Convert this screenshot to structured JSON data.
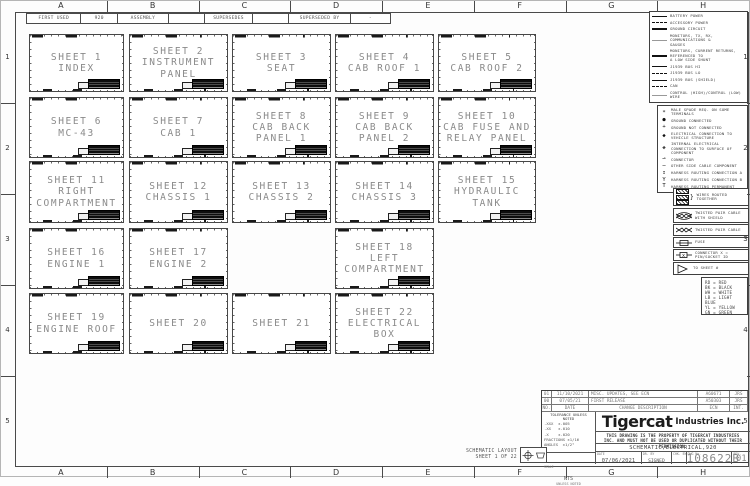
{
  "header_bar": {
    "cells": [
      "FIRST USED",
      "920",
      "ASSEMBLY",
      "",
      "SUPERSEDES",
      "",
      "SUPERSEDED BY",
      "-"
    ]
  },
  "border": {
    "columns": [
      "A",
      "B",
      "C",
      "D",
      "E",
      "F",
      "G",
      "H"
    ],
    "rows": [
      "1",
      "2",
      "3",
      "4",
      "5"
    ]
  },
  "sheets": [
    {
      "title": "SHEET 1",
      "lines": [
        "INDEX"
      ],
      "row": 0,
      "col": 0
    },
    {
      "title": "SHEET 2",
      "lines": [
        "INSTRUMENT",
        "PANEL"
      ],
      "row": 0,
      "col": 1
    },
    {
      "title": "SHEET 3",
      "lines": [
        "SEAT"
      ],
      "row": 0,
      "col": 2
    },
    {
      "title": "SHEET 4",
      "lines": [
        "CAB ROOF 1"
      ],
      "row": 0,
      "col": 3
    },
    {
      "title": "SHEET 5",
      "lines": [
        "CAB ROOF 2"
      ],
      "row": 0,
      "col": 4
    },
    {
      "title": "SHEET 6",
      "lines": [
        "MC-43"
      ],
      "row": 1,
      "col": 0
    },
    {
      "title": "SHEET 7",
      "lines": [
        "CAB 1"
      ],
      "row": 1,
      "col": 1
    },
    {
      "title": "SHEET 8",
      "lines": [
        "CAB BACK",
        "PANEL 1"
      ],
      "row": 1,
      "col": 2
    },
    {
      "title": "SHEET 9",
      "lines": [
        "CAB BACK",
        "PANEL 2"
      ],
      "row": 1,
      "col": 3
    },
    {
      "title": "SHEET 10",
      "lines": [
        "CAB FUSE AND",
        "RELAY PANEL"
      ],
      "row": 1,
      "col": 4
    },
    {
      "title": "SHEET 11",
      "lines": [
        "RIGHT",
        "COMPARTMENT"
      ],
      "row": 2,
      "col": 0
    },
    {
      "title": "SHEET 12",
      "lines": [
        "CHASSIS 1"
      ],
      "row": 2,
      "col": 1
    },
    {
      "title": "SHEET 13",
      "lines": [
        "CHASSIS 2"
      ],
      "row": 2,
      "col": 2
    },
    {
      "title": "SHEET 14",
      "lines": [
        "CHASSIS 3"
      ],
      "row": 2,
      "col": 3
    },
    {
      "title": "SHEET 15",
      "lines": [
        "HYDRAULIC",
        "TANK"
      ],
      "row": 2,
      "col": 4
    },
    {
      "title": "SHEET 16",
      "lines": [
        "ENGINE 1"
      ],
      "row": 3,
      "col": 0
    },
    {
      "title": "SHEET 17",
      "lines": [
        "ENGINE 2"
      ],
      "row": 3,
      "col": 1
    },
    {
      "title": "SHEET 18",
      "lines": [
        "LEFT",
        "COMPARTMENT"
      ],
      "row": 3,
      "col": 3
    },
    {
      "title": "SHEET 19",
      "lines": [
        "ENGINE ROOF"
      ],
      "row": 4,
      "col": 0
    },
    {
      "title": "SHEET 20",
      "lines": [],
      "row": 4,
      "col": 1
    },
    {
      "title": "SHEET 21",
      "lines": [],
      "row": 4,
      "col": 2
    },
    {
      "title": "SHEET 22",
      "lines": [
        "ELECTRICAL",
        "BOX"
      ],
      "row": 4,
      "col": 3
    }
  ],
  "legend": {
    "line_types": [
      {
        "style": "solid",
        "label": "BATTERY POWER"
      },
      {
        "style": "dash",
        "label": "ACCESSORY POWER"
      },
      {
        "style": "thick",
        "label": "GROUND CIRCUIT"
      },
      {
        "style": "thin",
        "label": "MONITORS, TX, RX, COMMUNICATIONS &",
        "label2": "GAUGES"
      },
      {
        "style": "thick",
        "label": "MONITORS, CURRENT RETURNS, REFERENCED TO",
        "label2": "A LOW SIDE SHUNT"
      },
      {
        "style": "solid",
        "label": "J1939 BUS HI"
      },
      {
        "style": "dash",
        "label": "J1939 BUS LO"
      },
      {
        "style": "solid",
        "label": "J1939 BUS (SHIELD)"
      },
      {
        "style": "dash",
        "label": "CAN"
      },
      {
        "style": "thin",
        "label": "CONTROL (HIGH)/CONTROL (LOW) WIRE"
      }
    ],
    "symbols": [
      {
        "icon": "∗",
        "icon_name": "spade-terminal-icon",
        "label": "MALE SPADE REQ. ON SOME TERMINALS"
      },
      {
        "icon": "●",
        "icon_name": "ground-connected-icon",
        "label": "GROUND CONNECTED"
      },
      {
        "icon": "+",
        "icon_name": "ground-not-connected-icon",
        "label": "GROUND NOT CONNECTED"
      },
      {
        "icon": "◆",
        "icon_name": "structure-connection-icon",
        "label": "ELECTRICAL CONNECTION TO VEHICLE STRUCTURE"
      },
      {
        "icon": "◈",
        "icon_name": "component-connection-icon",
        "label": "INTERNAL ELECTRICAL CONNECTION TO SURFACE OF COMPONENT"
      },
      {
        "icon": "⊸",
        "icon_name": "connector-icon",
        "label": "CONNECTOR"
      },
      {
        "icon": "⋯",
        "icon_name": "other-side-cable-icon",
        "label": "OTHER SIDE CABLE COMPONENT"
      },
      {
        "icon": "↧",
        "icon_name": "harness-routing-a-icon",
        "label": "HARNESS ROUTING CONNECTION A"
      },
      {
        "icon": "Y",
        "icon_name": "harness-routing-b-icon",
        "label": "HARNESS ROUTING CONNECTION B"
      },
      {
        "icon": "T",
        "icon_name": "harness-routing-perm-icon",
        "label": "HARNESS ROUTING PERMANENT"
      }
    ],
    "boxed": [
      {
        "icon": "routed",
        "label": "WIRES ROUTED TOGETHER"
      },
      {
        "icon": "twisted-shield",
        "label": "TWISTED PAIR CABLE WITH SHIELD"
      },
      {
        "icon": "twisted",
        "label": "TWISTED PAIR CABLE"
      },
      {
        "icon": "fuse",
        "label": "FUSE"
      },
      {
        "icon": "connector",
        "label": "CONNECTOR  X = PIN/SOCKET ID"
      },
      {
        "icon": "tosheet",
        "label": "TO SHEET #"
      }
    ],
    "wire_colors": [
      "RD = RED",
      "BK = BLACK",
      "WH = WHITE",
      "LB = LIGHT BLUE",
      "YL = YELLOW",
      "GN = GREEN"
    ]
  },
  "title_block": {
    "revision_headers": [
      "NO.",
      "DATE",
      "CHANGE DESCRIPTION",
      "ECN",
      "INT."
    ],
    "revisions": [
      [
        "01",
        "11/10/2021",
        "MISC. UPDATES, SEE ECN",
        "A60671",
        "JRS"
      ],
      [
        "00",
        "07/05/21",
        "FIRST RELEASE",
        "A50303",
        "JRS"
      ]
    ],
    "tolerance": {
      "header": "TOLERANCE UNLESS NOTED",
      "rows": [
        ".XXX  ±.005",
        ".XX   ±.010",
        ".X    ±.020",
        "FRACTIONS ±1/16",
        "ANGLES  ±1/2°"
      ]
    },
    "scale": {
      "label": "SCALE",
      "value": "NTS",
      "note": "UNLESS NOTED"
    },
    "company": "Tigercat",
    "company_suffix": "Industries Inc.",
    "property_note": "THIS DRAWING IS THE PROPERTY OF TIGERCAT INDUSTRIES INC. AND MUST NOT BE USED OR DUPLICATED WITHOUT THEIR PERMISSION.",
    "title": "SCHEMATIC,ELECTRICAL,920",
    "fields": {
      "date_label": "DATE",
      "date": "07/06/2021",
      "drawn_label": "DR. BY",
      "drawn": "SIGNED",
      "checked_label": "CHK. BY",
      "checked": "",
      "dwg_label": "DWG No.",
      "dwg": "108622B",
      "rev_label": "REV.",
      "rev": "01"
    }
  },
  "footer": {
    "layout_label": "SCHEMATIC LAYOUT",
    "sheet_label": "SHEET 1 OF 22"
  }
}
